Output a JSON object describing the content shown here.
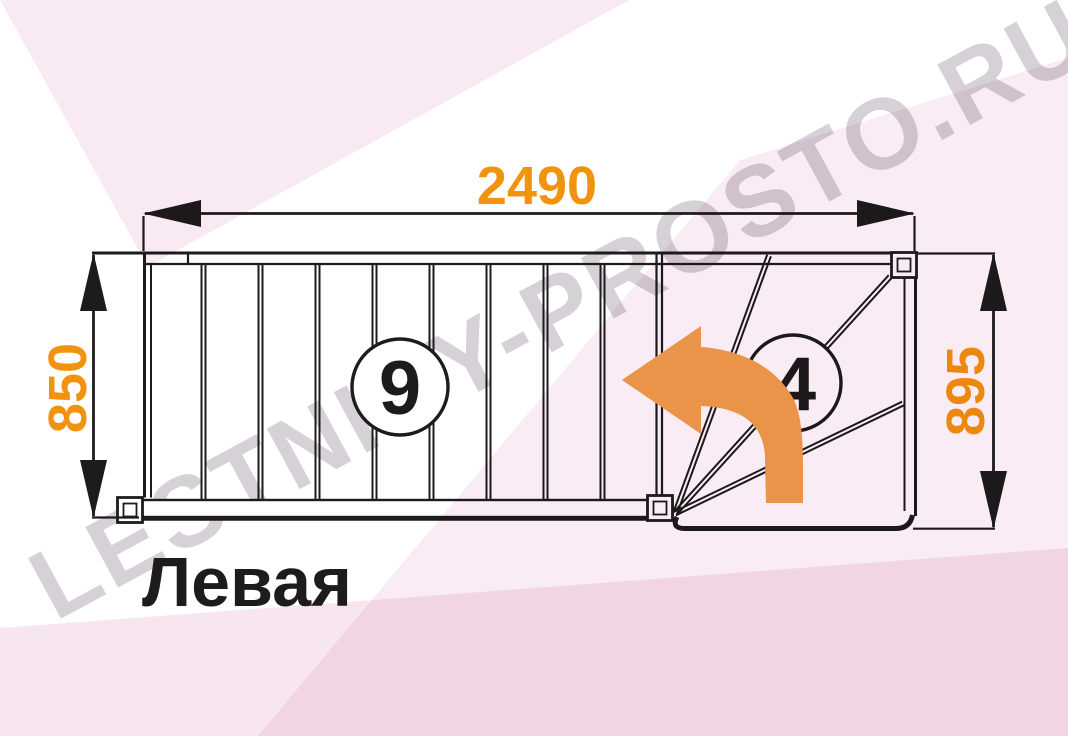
{
  "watermark": {
    "text": "LESTNICY-PROSTO.RU"
  },
  "diagram": {
    "title": "Левая",
    "turn_direction": "left",
    "dimensions": {
      "total_length": "2490",
      "flight_width": "850",
      "winder_width": "895"
    },
    "straight_flight": {
      "step_count": "9"
    },
    "winder": {
      "step_count": "4"
    }
  },
  "colors": {
    "dimension_orange": "#f2930d",
    "arrow_orange": "#efa04c",
    "line_dark": "#1d1b1c",
    "pink_tint": "#f8e9f2",
    "watermark_gray": "#d5d1d6"
  }
}
